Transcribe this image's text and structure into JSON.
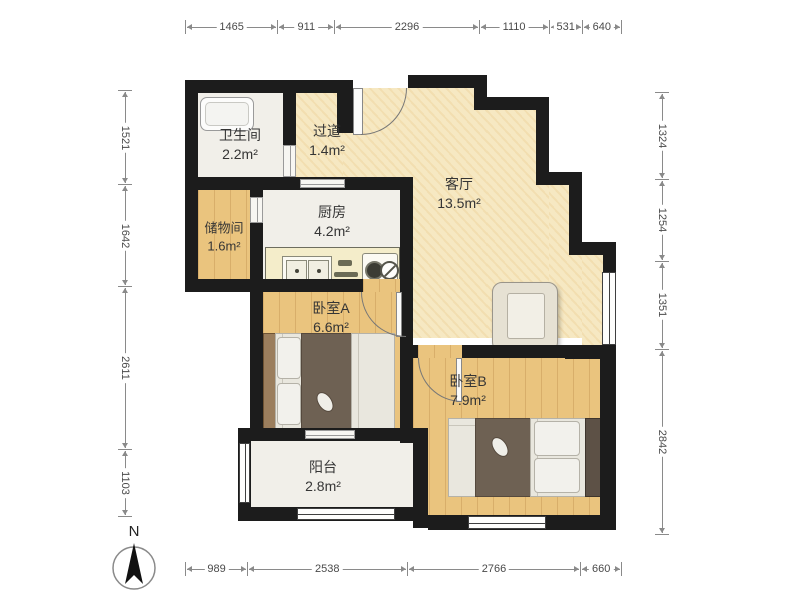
{
  "title": "两室一厅户型图",
  "compass": {
    "label": "N"
  },
  "rulers": {
    "unit": "mm",
    "top": [
      "1465",
      "911",
      "2296",
      "1110",
      "531",
      "640"
    ],
    "bottom": [
      "989",
      "2538",
      "2766",
      "660"
    ],
    "left": [
      "1521",
      "1642",
      "2611",
      "1103"
    ],
    "right": [
      "1324",
      "1254",
      "1351",
      "2842"
    ]
  },
  "rooms": {
    "bathroom": {
      "name": "卫生间",
      "area": "2.2m²"
    },
    "hallway": {
      "name": "过道",
      "area": "1.4m²"
    },
    "storage": {
      "name": "储物间",
      "area": "1.6m²"
    },
    "kitchen": {
      "name": "厨房",
      "area": "4.2m²"
    },
    "living": {
      "name": "客厅",
      "area": "13.5m²"
    },
    "bedroomA": {
      "name": "卧室A",
      "area": "6.6m²"
    },
    "bedroomB": {
      "name": "卧室B",
      "area": "7.9m²"
    },
    "balcony": {
      "name": "阳台",
      "area": "2.8m²"
    }
  },
  "colors": {
    "wall": "#1c1c1c",
    "floor_wood": "#eac47e",
    "floor_beige": "#f6e8c2",
    "floor_white": "#f1efe9",
    "counter": "#f4edca",
    "blanket": "#6e6153",
    "headboard": "#9b7e5d",
    "dimension_line": "#8a8a8a"
  }
}
